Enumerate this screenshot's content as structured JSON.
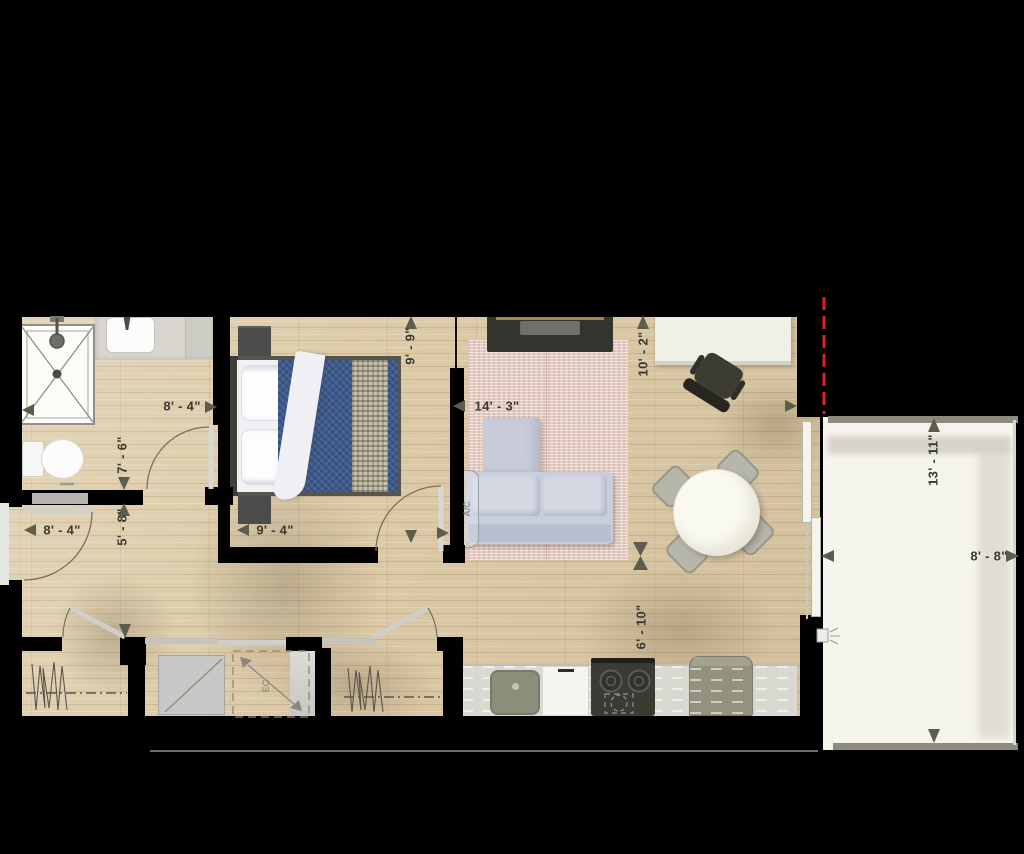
{
  "plan_title": "one-bedroom apartment floor plan",
  "dimensions": {
    "bathroom_width": "8' - 4\"",
    "bathroom_length": "7' - 6\"",
    "hall_length": "5' - 8\"",
    "entry_width": "8' - 4\"",
    "bedroom_width": "9' - 4\"",
    "bedroom_length": "9' - 9\"",
    "living_room_width": "14' - 3\"",
    "living_room_length": "10' - 2\"",
    "kitchen_length": "6' - 10\"",
    "balcony_length": "13' - 11\"",
    "balcony_width": "8' - 8\""
  },
  "labels": {
    "ac_unit": "A/C",
    "appliance_above": "EC"
  },
  "colors": {
    "background": "#000000",
    "walls": "#000000",
    "floor_wood": "#dccaa6",
    "balcony_floor": "#f6f5ed",
    "duvet_blue": "#3e5c90",
    "rug_pink": "#e4cdc2",
    "sofa_gray": "#c9cedb",
    "counter_gray": "#d9d9d1",
    "dimension_text": "#3a3a32",
    "arrow": "#5d5d4d",
    "red_dashed_line": "#e22222"
  }
}
